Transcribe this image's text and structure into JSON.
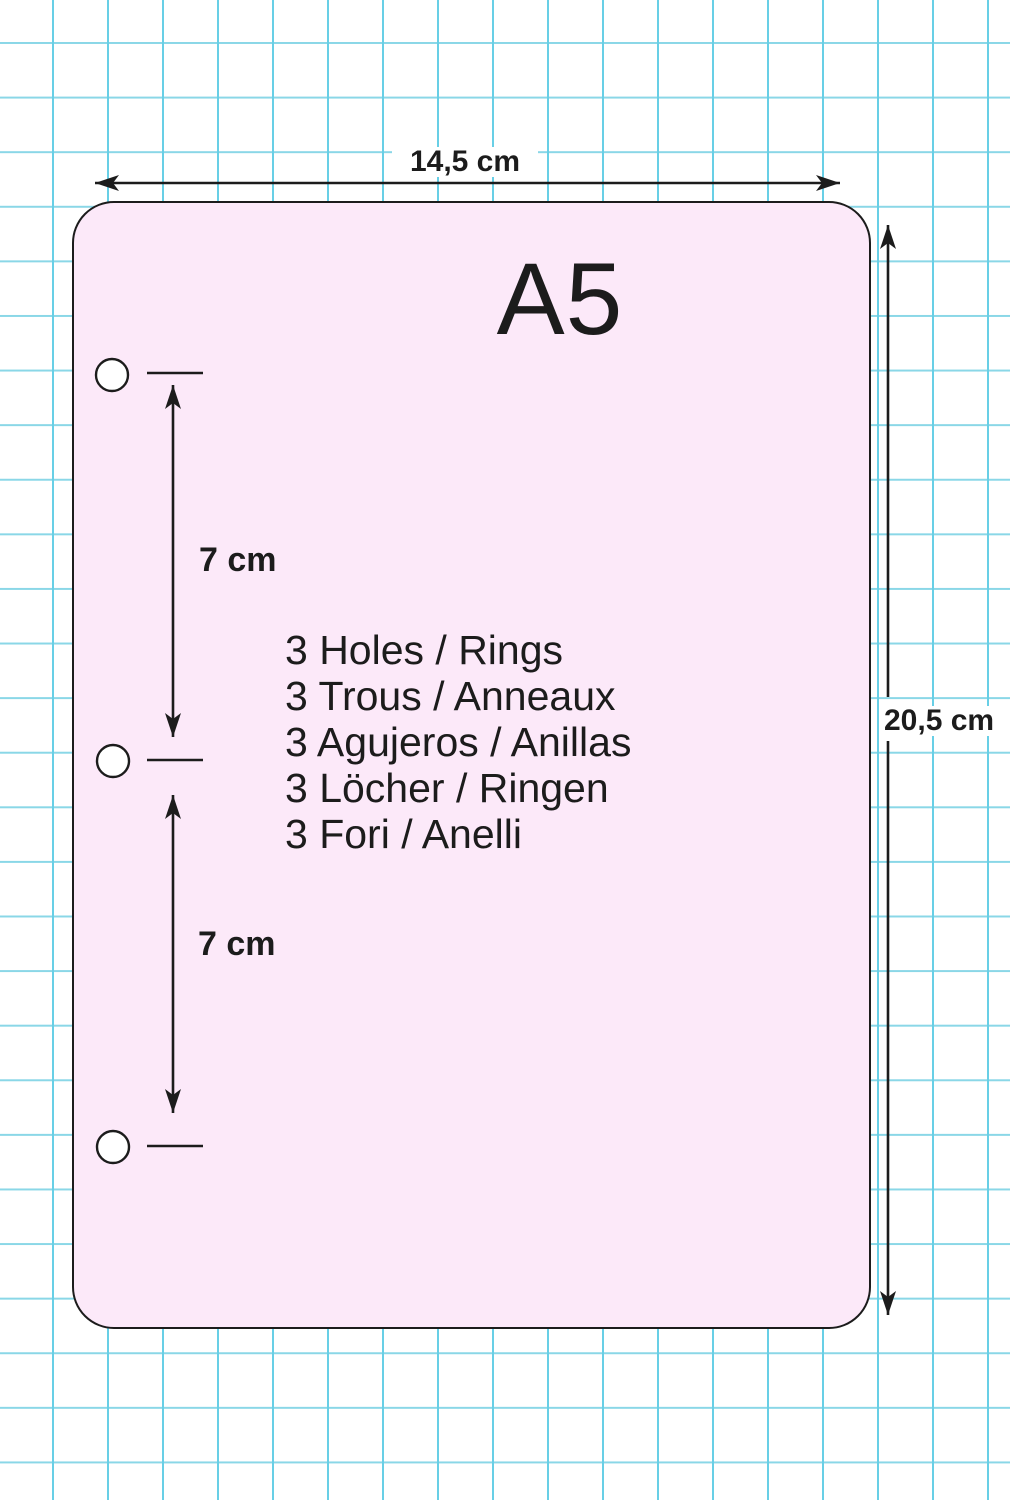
{
  "title": "A5 sheet hole-punch dimension diagram",
  "colors": {
    "sheet_fill": "#FCE9F9",
    "grid_line_v": "#68CFE6",
    "grid_line_h": "#8AD7E7",
    "ink": "#1C1C1C"
  },
  "sheet": {
    "format_label": "A5",
    "width_label": "14,5 cm",
    "height_label": "20,5 cm",
    "hole_spacing_labels": [
      "7 cm",
      "7 cm"
    ],
    "features": [
      "3 Holes / Rings",
      "3 Trous / Anneaux",
      "3 Agujeros / Anillas",
      "3 Löcher / Ringen",
      "3 Fori / Anelli"
    ]
  }
}
